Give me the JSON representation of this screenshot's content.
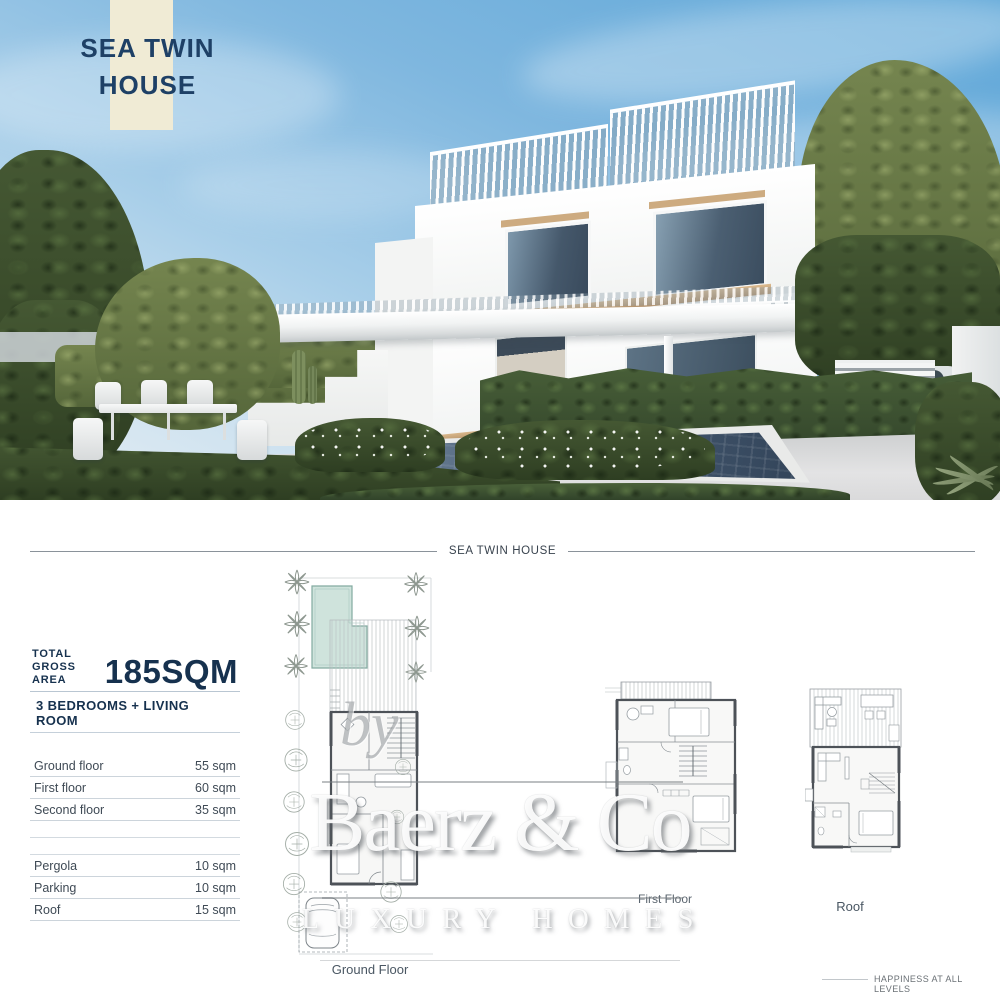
{
  "header": {
    "project_title_line1": "SEA TWIN",
    "project_title_line2": "HOUSE"
  },
  "plan_section": {
    "divider_title": "SEA TWIN HOUSE",
    "specs": {
      "total_label_line1": "TOTAL",
      "total_label_line2": "GROSS AREA",
      "total_value": "185SQM",
      "subtitle": "3 BEDROOMS + LIVING ROOM",
      "rows": [
        {
          "label": "Ground floor",
          "value": "55 sqm"
        },
        {
          "label": "First floor",
          "value": "60 sqm"
        },
        {
          "label": "Second floor",
          "value": "35 sqm"
        },
        {
          "label": "Pergola",
          "value": "10 sqm"
        },
        {
          "label": "Parking",
          "value": "10 sqm"
        },
        {
          "label": "Roof",
          "value": "15 sqm"
        }
      ]
    },
    "floor_labels": [
      {
        "label": "Ground Floor"
      },
      {
        "label": "First Floor"
      },
      {
        "label": "Roof"
      }
    ]
  },
  "watermark": {
    "by": "by",
    "brand": "Baerz & Co",
    "tagline": "LUXURY HOMES"
  },
  "footer": {
    "tagline": "HAPPINESS AT ALL LEVELS"
  },
  "colors": {
    "navy": "#1e4066",
    "cream": "#f0ebd5",
    "pool_plan_teal": "#cfe3dc",
    "sky_blue": "#7fb7df",
    "pool_water": "#445870"
  }
}
